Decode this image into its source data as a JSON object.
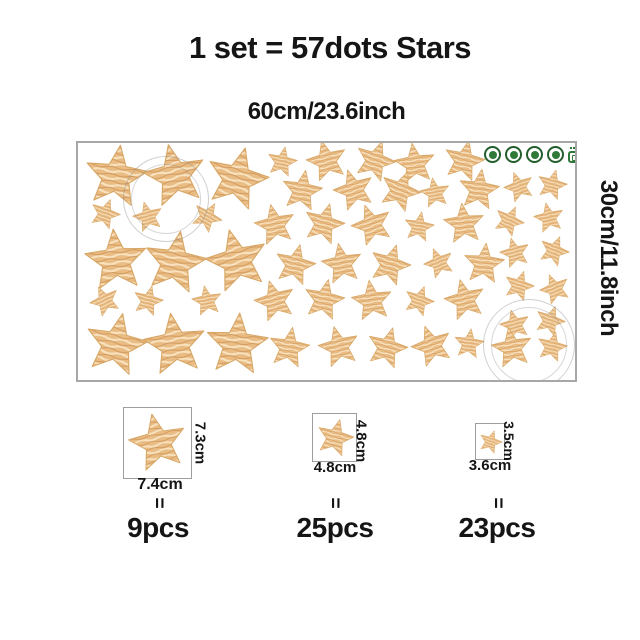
{
  "header": {
    "title": "1 set = 57dots Stars"
  },
  "sheet": {
    "width_label": "60cm/23.6inch",
    "height_label": "30cm/11.8inch",
    "border_color": "#a7a7a7",
    "star_palette": {
      "base": "#e9bc84",
      "light": "#f8e2bf",
      "dark": "#d2995c",
      "outline": "#d8a766"
    },
    "badge_color": "#2f7a38",
    "badges": [
      "eco-cert-icon",
      "eco-cert-icon",
      "eco-cert-icon",
      "eco-cert-icon",
      "eco-chip-icon"
    ],
    "star_sizes": {
      "l": 32,
      "m": 21,
      "s": 15.5
    },
    "stars": [
      [
        38,
        34,
        8,
        "l"
      ],
      [
        97,
        33,
        -12,
        "l"
      ],
      [
        159,
        36,
        15,
        "l"
      ],
      [
        38,
        118,
        -5,
        "l"
      ],
      [
        97,
        120,
        10,
        "l"
      ],
      [
        159,
        118,
        -14,
        "l"
      ],
      [
        38,
        202,
        12,
        "l"
      ],
      [
        97,
        202,
        -8,
        "l"
      ],
      [
        159,
        202,
        5,
        "l"
      ],
      [
        27,
        71,
        20,
        "s"
      ],
      [
        70,
        74,
        -15,
        "s"
      ],
      [
        129,
        74,
        30,
        "s"
      ],
      [
        27,
        158,
        -25,
        "s"
      ],
      [
        70,
        158,
        15,
        "s"
      ],
      [
        129,
        158,
        -10,
        "s"
      ],
      [
        204,
        19,
        12,
        "s"
      ],
      [
        249,
        18,
        -15,
        "m"
      ],
      [
        297,
        18,
        20,
        "m"
      ],
      [
        337,
        21,
        -8,
        "m"
      ],
      [
        386,
        18,
        14,
        "m"
      ],
      [
        224,
        48,
        10,
        "m"
      ],
      [
        276,
        47,
        -18,
        "m"
      ],
      [
        322,
        48,
        22,
        "m"
      ],
      [
        357,
        50,
        -10,
        "s"
      ],
      [
        401,
        47,
        8,
        "m"
      ],
      [
        441,
        44,
        -20,
        "s"
      ],
      [
        474,
        42,
        15,
        "s"
      ],
      [
        197,
        82,
        -12,
        "m"
      ],
      [
        246,
        81,
        16,
        "m"
      ],
      [
        294,
        82,
        -20,
        "m"
      ],
      [
        341,
        84,
        10,
        "s"
      ],
      [
        386,
        81,
        -6,
        "m"
      ],
      [
        431,
        78,
        25,
        "s"
      ],
      [
        471,
        75,
        -12,
        "s"
      ],
      [
        437,
        110,
        -15,
        "s"
      ],
      [
        476,
        108,
        22,
        "s"
      ],
      [
        217,
        122,
        14,
        "m"
      ],
      [
        264,
        121,
        -10,
        "m"
      ],
      [
        312,
        122,
        18,
        "m"
      ],
      [
        361,
        120,
        -22,
        "s"
      ],
      [
        406,
        121,
        6,
        "m"
      ],
      [
        441,
        143,
        18,
        "s"
      ],
      [
        477,
        146,
        -22,
        "s"
      ],
      [
        197,
        158,
        -16,
        "m"
      ],
      [
        246,
        157,
        12,
        "m"
      ],
      [
        294,
        158,
        -8,
        "m"
      ],
      [
        341,
        158,
        20,
        "s"
      ],
      [
        387,
        157,
        -14,
        "m"
      ],
      [
        437,
        182,
        -15,
        "s"
      ],
      [
        472,
        178,
        20,
        "s"
      ],
      [
        211,
        205,
        10,
        "m"
      ],
      [
        261,
        204,
        -14,
        "m"
      ],
      [
        309,
        205,
        16,
        "m"
      ],
      [
        354,
        203,
        -20,
        "m"
      ],
      [
        391,
        201,
        8,
        "s"
      ],
      [
        434,
        205,
        -10,
        "m"
      ],
      [
        474,
        204,
        14,
        "s"
      ]
    ]
  },
  "legend": {
    "equals": "=",
    "items": [
      {
        "height_label": "7.3cm",
        "width_label": "7.4cm",
        "count_label": "9pcs",
        "rotation": -12,
        "size_key": "l"
      },
      {
        "height_label": "4.8cm",
        "width_label": "4.8cm",
        "count_label": "25pcs",
        "rotation": 15,
        "size_key": "m"
      },
      {
        "height_label": "3.5cm",
        "width_label": "3.6cm",
        "count_label": "23pcs",
        "rotation": 18,
        "size_key": "s"
      }
    ]
  }
}
